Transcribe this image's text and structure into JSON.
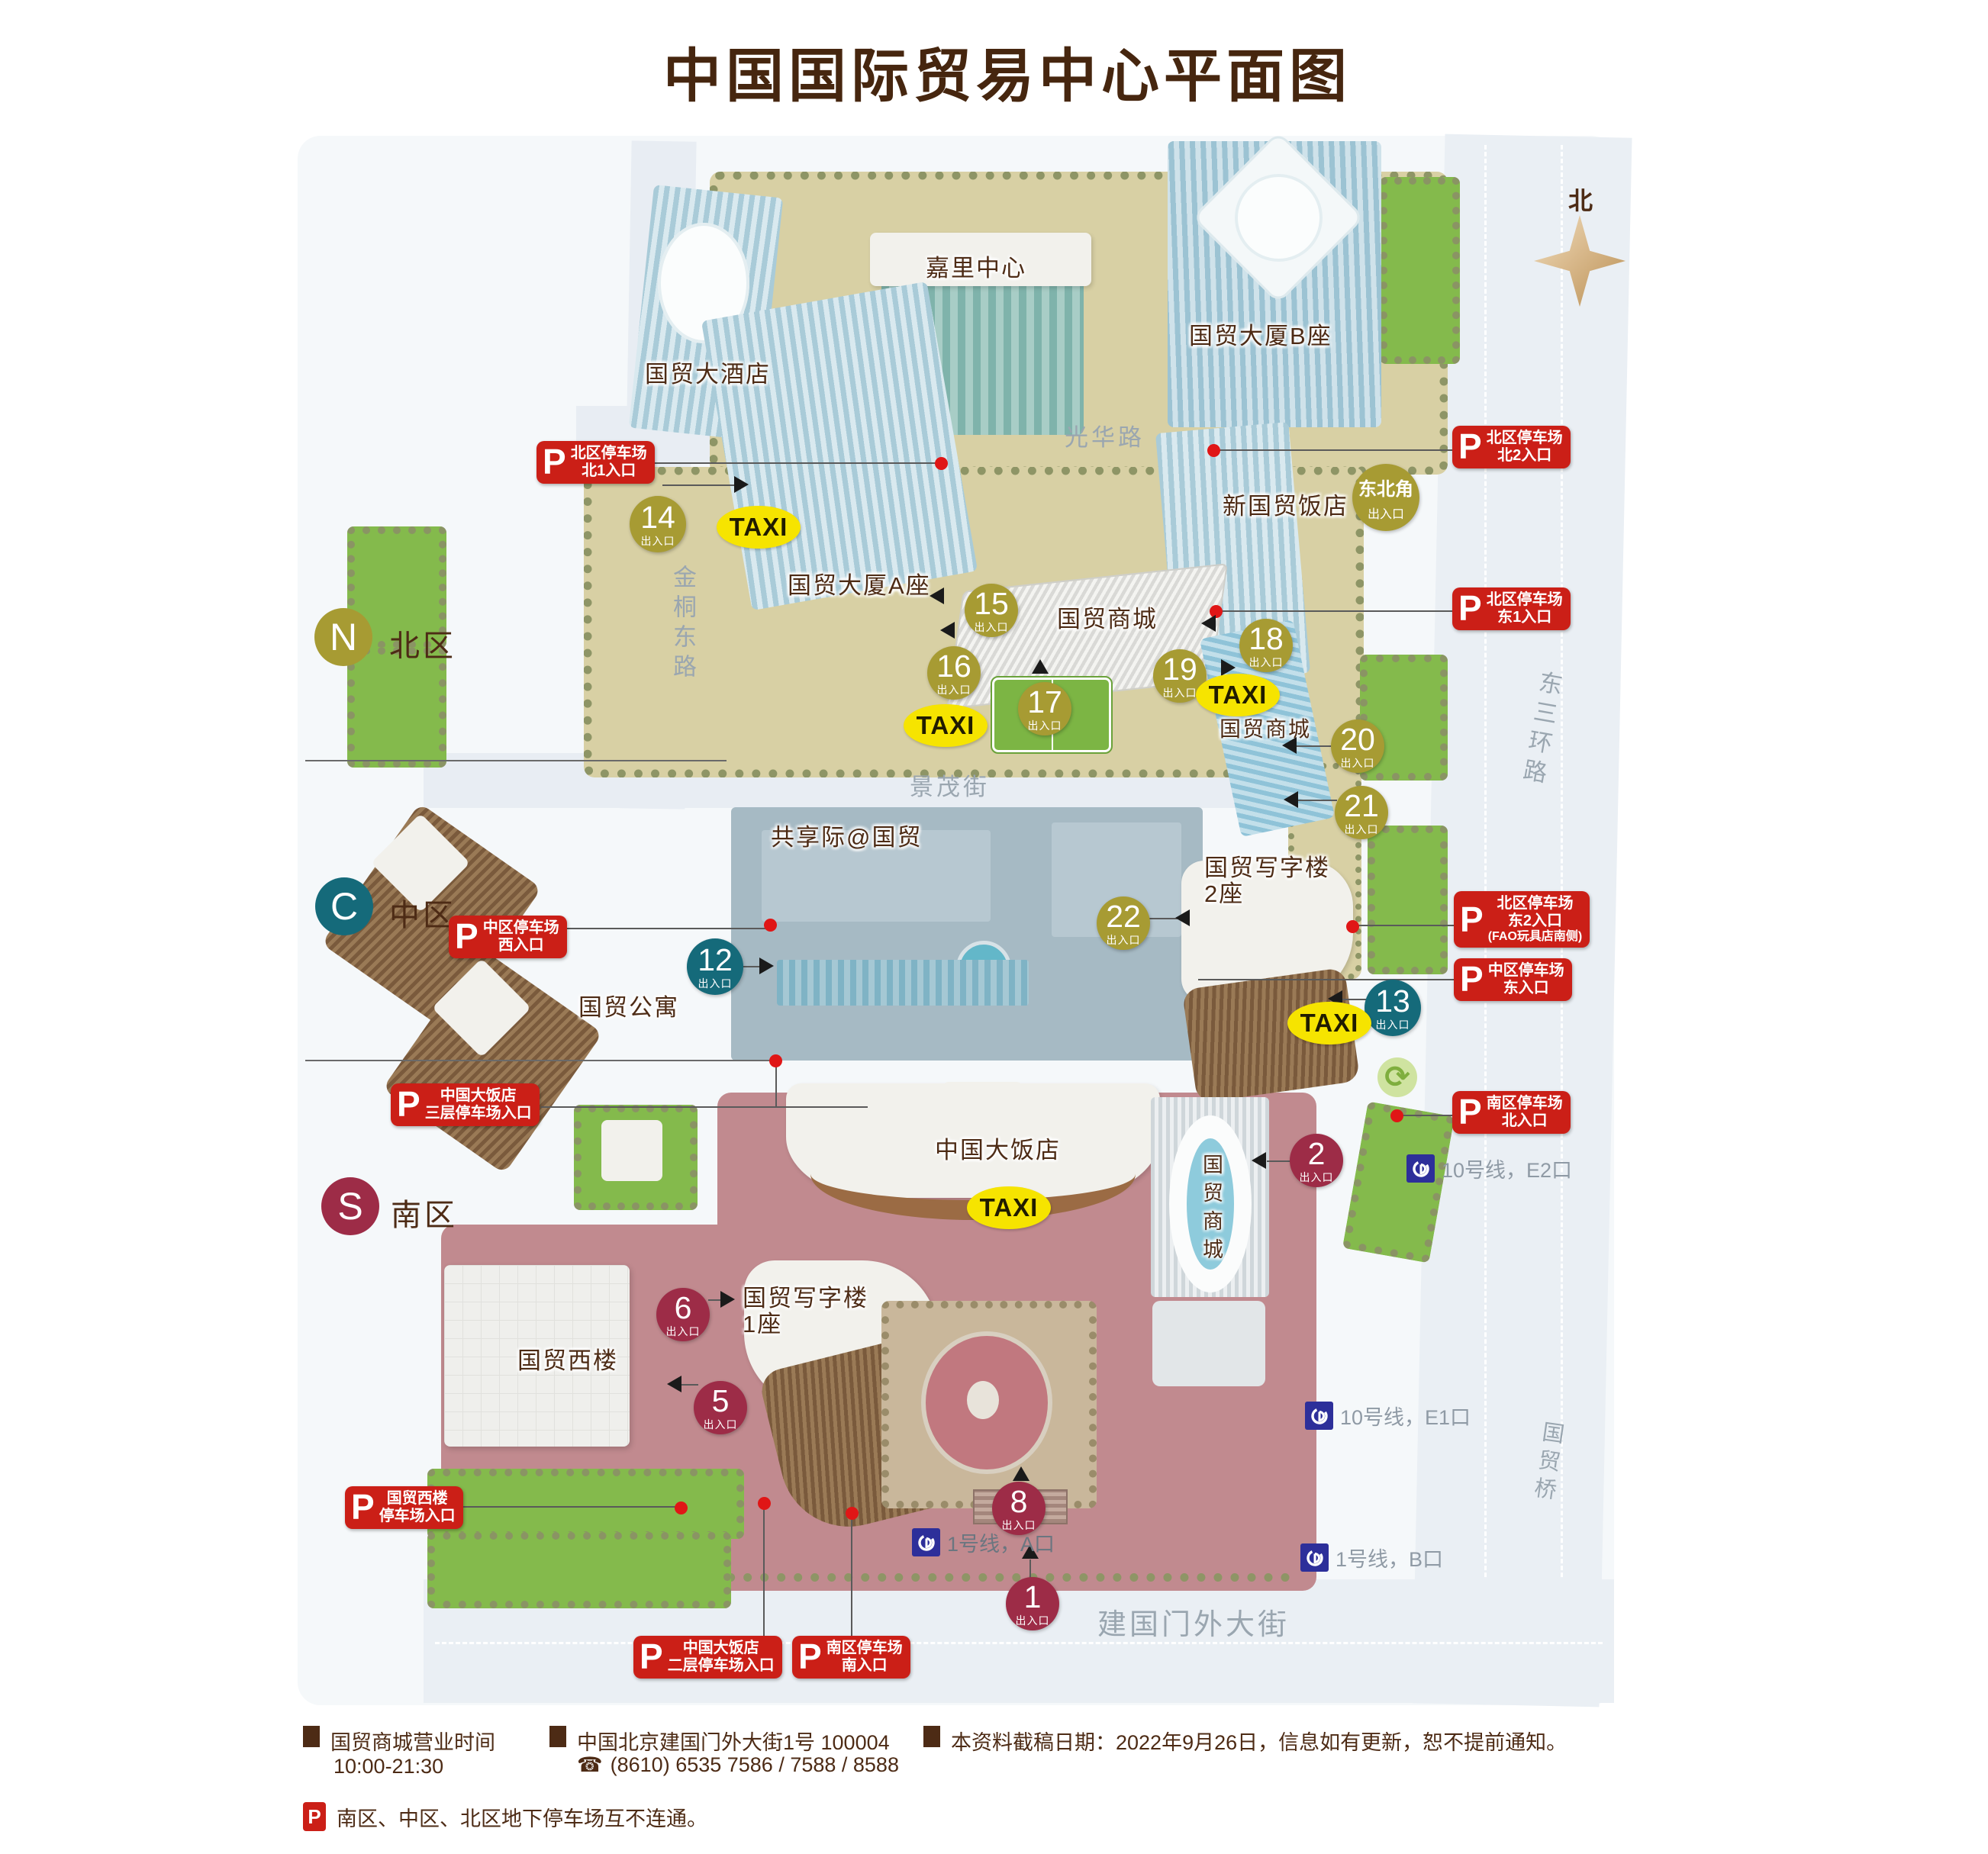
{
  "title": "中国国际贸易中心平面图",
  "compass_label": "北",
  "icons": {
    "roundabout": "⟳",
    "phone": "☎"
  },
  "streets": {
    "guanghua": "光华路",
    "jintongdong": "金桐东路",
    "jingmao": "景茂街",
    "dongsanhuan": "东三环路",
    "jianguomenwai": "建国门外大街",
    "guomao_bridge": "国贸桥"
  },
  "zones": {
    "north": {
      "letter": "N",
      "label": "北区"
    },
    "central": {
      "letter": "C",
      "label": "中区"
    },
    "south": {
      "letter": "S",
      "label": "南区"
    }
  },
  "buildings": {
    "kerry_center": "嘉里中心",
    "cwt_tower_b": "国贸大厦B座",
    "traders_hotel": "国贸大酒店",
    "cwt_tower_a": "国贸大厦A座",
    "new_cwt_hotel": "新国贸饭店",
    "mall_north": "国贸商城",
    "mall_east": "国贸商城",
    "shared_space": "共享际@国贸",
    "office2_l1": "国贸写字楼",
    "office2_l2": "2座",
    "apartments": "国贸公寓",
    "china_world_hotel": "中国大饭店",
    "mall_south": "国贸商城",
    "west_wing": "国贸西楼",
    "office1_l1": "国贸写字楼",
    "office1_l2": "1座"
  },
  "exit_sub": "出入口",
  "exits": {
    "e1": "1",
    "e2": "2",
    "e5": "5",
    "e6": "6",
    "e8": "8",
    "e12": "12",
    "e13": "13",
    "e14": "14",
    "e15": "15",
    "e16": "16",
    "e17": "17",
    "e18": "18",
    "e19": "19",
    "e20": "20",
    "e21": "21",
    "e22": "22"
  },
  "northeast_corner": {
    "line1": "东北角",
    "line2": "出入口"
  },
  "taxi_label": "TAXI",
  "parking_badges": {
    "north1": [
      "北区停车场",
      "北1入口"
    ],
    "north2": [
      "北区停车场",
      "北2入口"
    ],
    "east1": [
      "北区停车场",
      "东1入口"
    ],
    "east2": [
      "北区停车场",
      "东2入口",
      "(FAO玩具店南侧)"
    ],
    "central_west": [
      "中区停车场",
      "西入口"
    ],
    "central_east": [
      "中区停车场",
      "东入口"
    ],
    "hotel_l3": [
      "中国大饭店",
      "三层停车场入口"
    ],
    "south_north": [
      "南区停车场",
      "北入口"
    ],
    "west_wing": [
      "国贸西楼",
      "停车场入口"
    ],
    "hotel_l2": [
      "中国大饭店",
      "二层停车场入口"
    ],
    "south_south": [
      "南区停车场",
      "南入口"
    ]
  },
  "subway": {
    "line10_e2": "10号线，E2口",
    "line10_e1": "10号线，E1口",
    "line1_a": "1号线，A口",
    "line1_b": "1号线，B口"
  },
  "footer": {
    "hours_title": "国贸商城营业时间",
    "hours_value": "10:00-21:30",
    "address": "中国北京建国门外大街1号  100004",
    "phone": "(8610) 6535 7586 / 7588 / 8588",
    "notice": "本资料截稿日期：2022年9月26日，信息如有更新，恕不提前通知。",
    "parking_note": "南区、中区、北区地下停车场互不连通。"
  },
  "colors": {
    "badge_red": "#cb1f17",
    "exit_north": "#a79b33",
    "exit_central": "#156a7a",
    "exit_south": "#9d2c47",
    "taxi_yellow": "#f6e400",
    "subway_blue": "#2d2f9a",
    "title_brown": "#46260f"
  }
}
